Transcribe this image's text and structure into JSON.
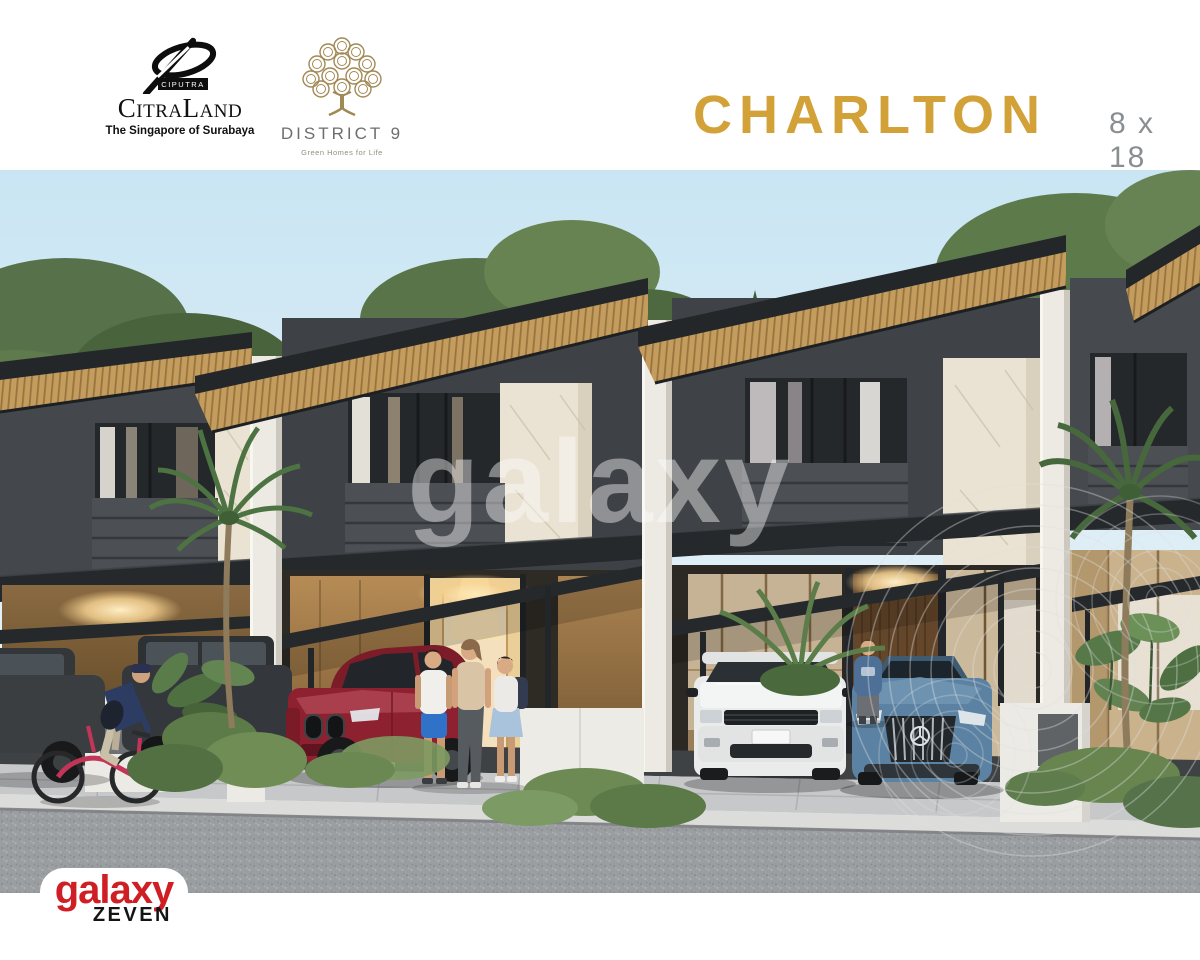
{
  "header": {
    "citraland": {
      "mark_text": "CIPUTRA",
      "name": "CitraLand",
      "tagline": "The Singapore of Surabaya"
    },
    "district9": {
      "name": "DISTRICT 9",
      "tagline": "Green Homes for Life"
    },
    "product": {
      "title": "CHARLTON",
      "size": "8 x 18"
    }
  },
  "watermark": {
    "brand": "galaxy"
  },
  "footer_logo": {
    "brand": "galaxy",
    "series": "ZEVEN"
  },
  "colors": {
    "title_gold": "#D2A138",
    "size_gray": "#8B8E91",
    "logo_red": "#D01F24",
    "district9_bronze": "#A18954",
    "sky": "#C9E5F3",
    "roof_wood": "#C49C5E",
    "facade_dark": "#3E4246",
    "marble": "#EAE3D3",
    "asphalt": "#9B9EA1"
  },
  "icons": {
    "citraland-logo-mark": "ellipse-swoosh",
    "district9-logo-mark": "circle-tree",
    "watermark-rings": "concentric-circles"
  }
}
